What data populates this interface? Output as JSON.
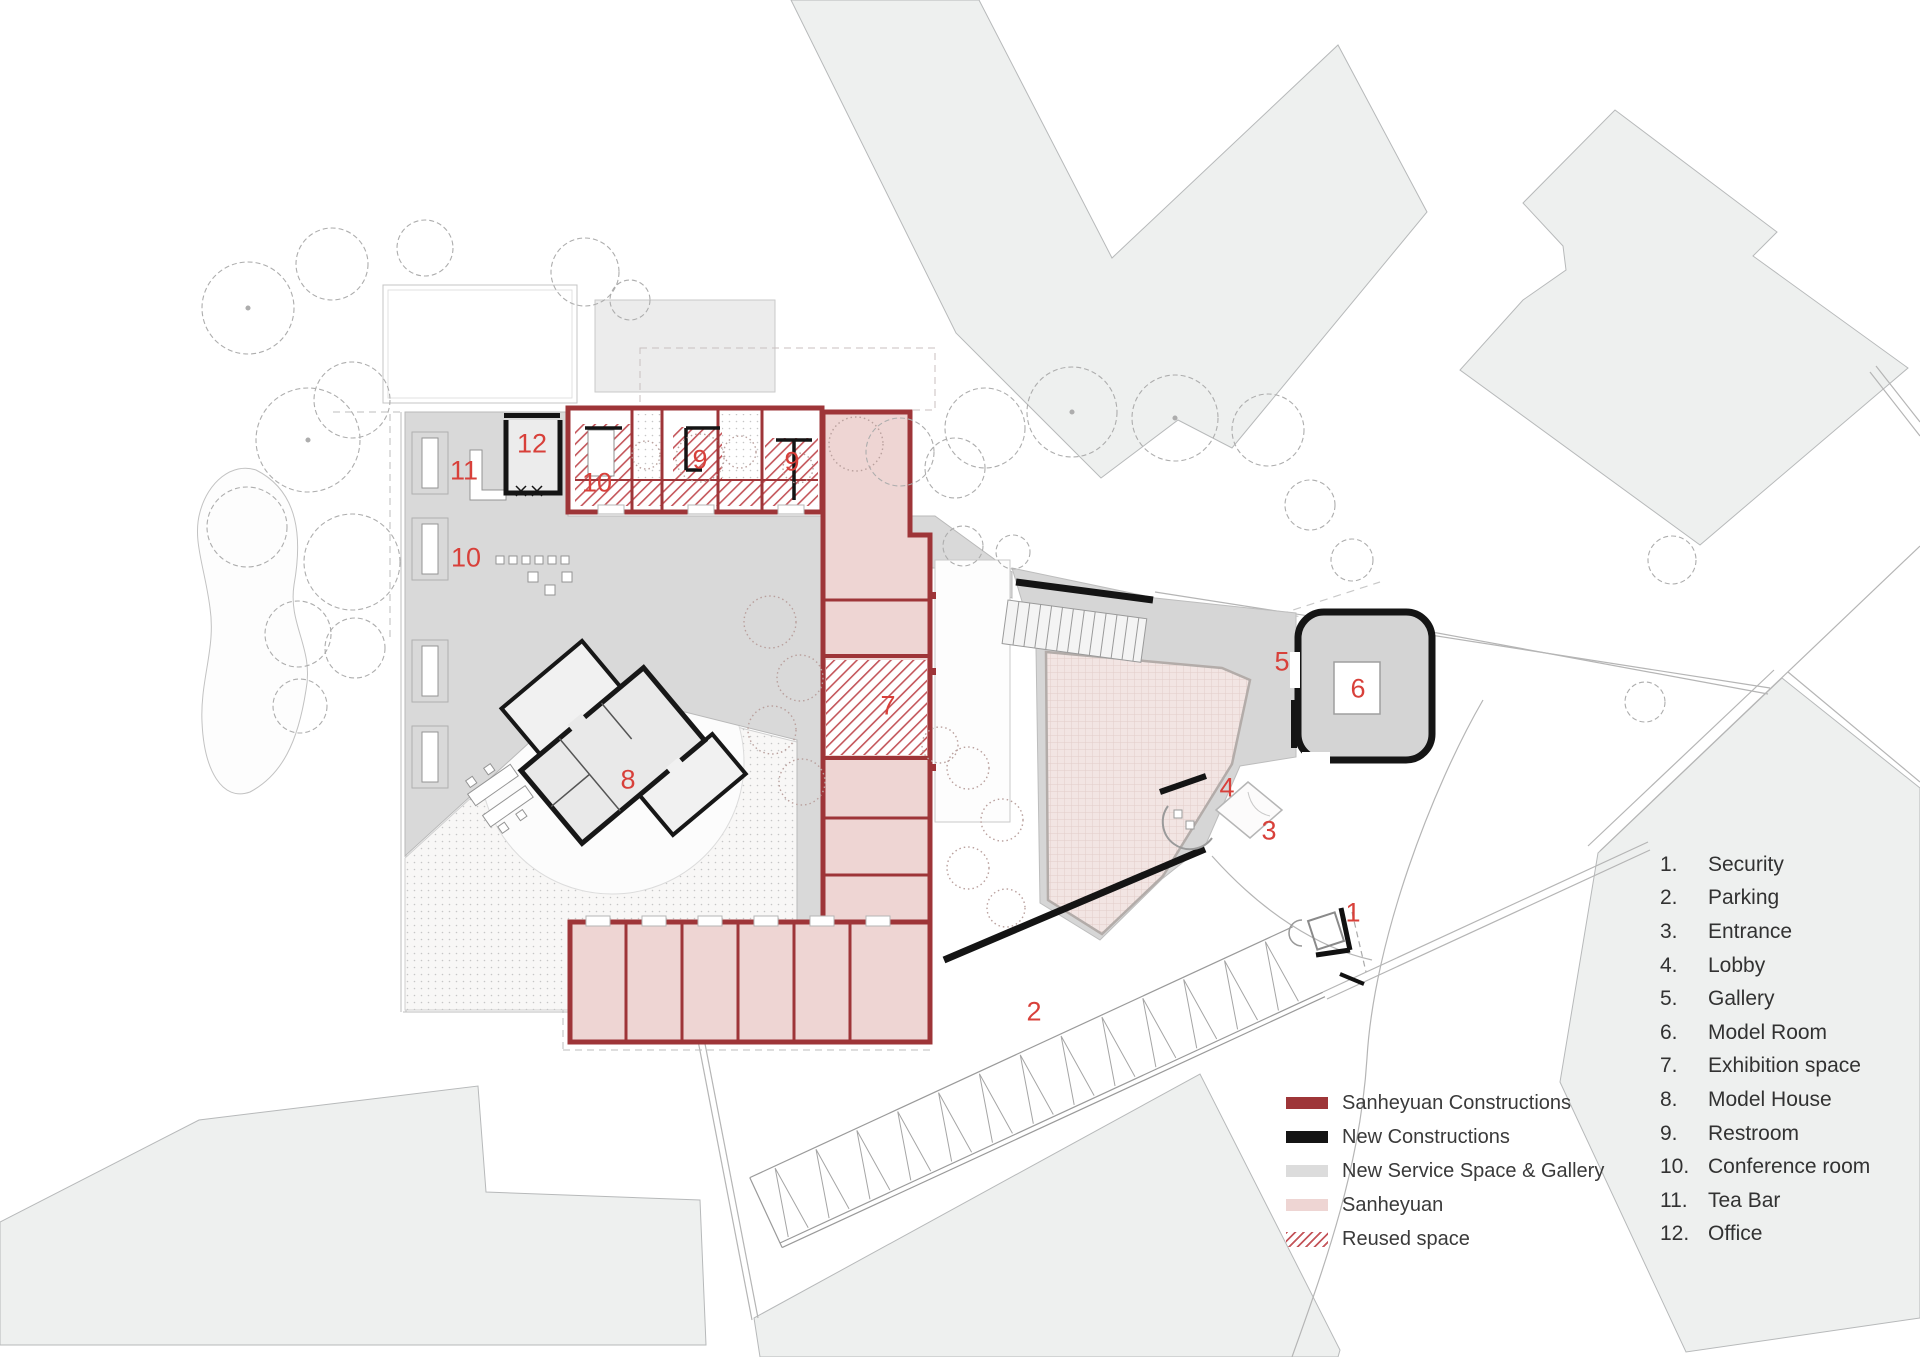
{
  "colors": {
    "label_red": "#d8403a",
    "wall_red": "#9e3538",
    "wall_black": "#141414",
    "service_gray": "#d9d9d9",
    "sanheyuan_pink": "#eed5d3",
    "hatch_red": "#c4555a",
    "context_gray": "#eef0ef"
  },
  "legend": {
    "items": [
      {
        "id": "sanheyuan-constructions",
        "swatch_type": "solid",
        "swatch_color": "#9e3538",
        "label": "Sanheyuan Constructions"
      },
      {
        "id": "new-constructions",
        "swatch_type": "solid",
        "swatch_color": "#141414",
        "label": "New Constructions"
      },
      {
        "id": "new-service-space-gallery",
        "swatch_type": "solid",
        "swatch_color": "#dcdcdc",
        "label": "New Service Space & Gallery"
      },
      {
        "id": "sanheyuan",
        "swatch_type": "solid",
        "swatch_color": "#eed5d3",
        "label": "Sanheyuan"
      },
      {
        "id": "reused-space",
        "swatch_type": "hatch",
        "swatch_color": "#c4555a",
        "label": "Reused space"
      }
    ]
  },
  "key": {
    "items": [
      {
        "num": "1.",
        "label": "Security"
      },
      {
        "num": "2.",
        "label": "Parking"
      },
      {
        "num": "3.",
        "label": "Entrance"
      },
      {
        "num": "4.",
        "label": "Lobby"
      },
      {
        "num": "5.",
        "label": "Gallery"
      },
      {
        "num": "6.",
        "label": "Model Room"
      },
      {
        "num": "7.",
        "label": "Exhibition space"
      },
      {
        "num": "8.",
        "label": "Model House"
      },
      {
        "num": "9.",
        "label": "Restroom"
      },
      {
        "num": "10.",
        "label": "Conference room"
      },
      {
        "num": "11.",
        "label": "Tea Bar"
      },
      {
        "num": "12.",
        "label": "Office"
      }
    ]
  },
  "plan_labels": [
    {
      "n": "1",
      "x": 1353,
      "y": 913
    },
    {
      "n": "2",
      "x": 1034,
      "y": 1012
    },
    {
      "n": "3",
      "x": 1269,
      "y": 831
    },
    {
      "n": "4",
      "x": 1227,
      "y": 788
    },
    {
      "n": "5",
      "x": 1282,
      "y": 662
    },
    {
      "n": "6",
      "x": 1358,
      "y": 689
    },
    {
      "n": "7",
      "x": 888,
      "y": 706
    },
    {
      "n": "8",
      "x": 628,
      "y": 780
    },
    {
      "n": "9",
      "x": 700,
      "y": 460
    },
    {
      "n": "9",
      "x": 792,
      "y": 462
    },
    {
      "n": "10",
      "x": 597,
      "y": 483
    },
    {
      "n": "10",
      "x": 466,
      "y": 558
    },
    {
      "n": "11",
      "x": 464,
      "y": 471
    },
    {
      "n": "12",
      "x": 532,
      "y": 444
    }
  ]
}
